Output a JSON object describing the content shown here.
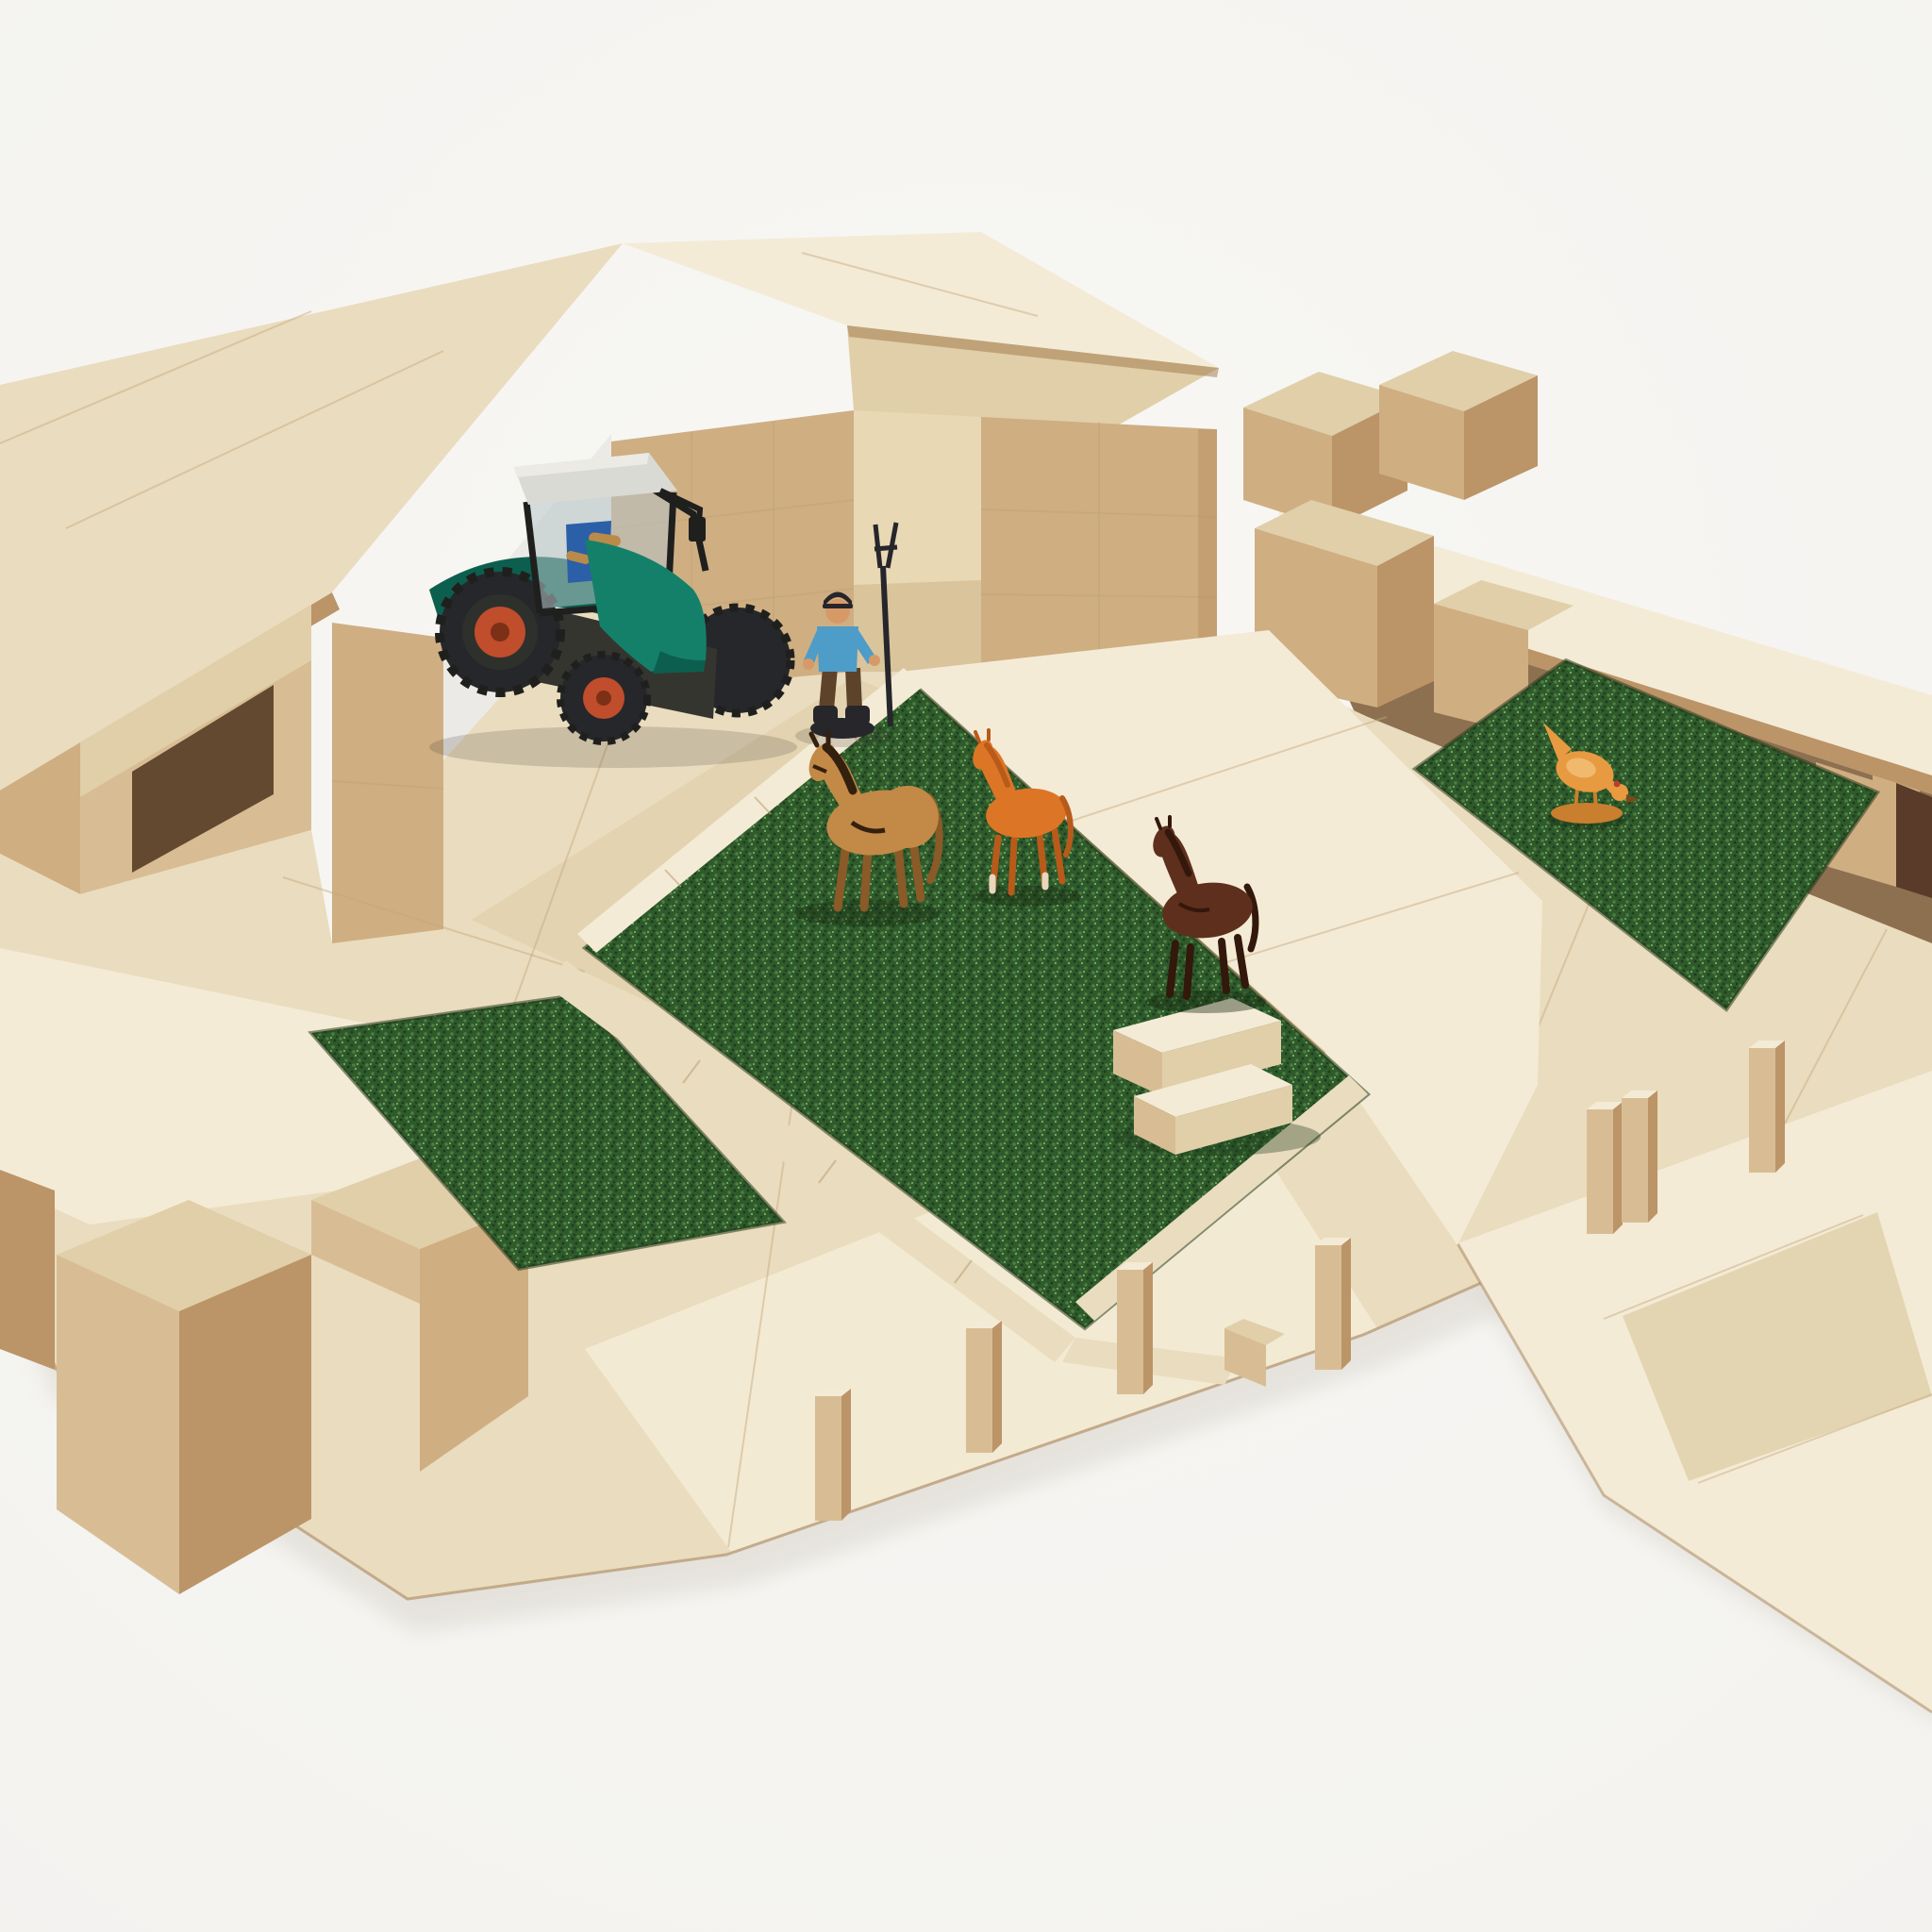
{
  "scene": {
    "type": "product photograph",
    "description": "Toy farm built from natural wooden building blocks and plywood panels on a white studio background: a barn with sloped plywood roofs shelters a green toy tractor, a farmer figure with a pitchfork stands by the entrance, a turf paddock fenced with flat wooden rails holds a tan horse, an orange foal and a dark brown horse beside a block feeding trough, a low shed with a flat plywood roof covers a second turf patch with a pecking hen, a small turf strip sits on the left platform, and upright fence-post blocks line the foreground beside a plywood driveway."
  },
  "objects": {
    "barn": {
      "label": "block barn with plywood gable roof"
    },
    "left_stable": {
      "label": "open stable wing with dark doorway"
    },
    "tractor_bay": {
      "label": "open tractor bay"
    },
    "right_shed": {
      "label": "low shed with flat plywood roof and blocks on top"
    },
    "tractor": {
      "label": "green toy tractor with white cab, black roll cage and red wheel hubs"
    },
    "farmer": {
      "label": "farmer figure in blue shirt holding a black pitchfork"
    },
    "paddock": {
      "label": "artificial turf paddock edged with flat wooden rails"
    },
    "walkway": {
      "label": "raised plywood walkway between paddock and shed turf"
    },
    "trough": {
      "label": "feeding trough stacked from small wooden blocks"
    },
    "horse_mare": {
      "label": "tan horse with dark mane and harness"
    },
    "horse_foal": {
      "label": "orange foal with pale lower legs"
    },
    "horse_brown": {
      "label": "dark brown horse"
    },
    "chicken": {
      "label": "orange hen pecking the turf"
    },
    "left_grass": {
      "label": "small turf strip inlaid in the left platform"
    },
    "right_grass": {
      "label": "turf patch in front of the shed"
    },
    "driveway": {
      "label": "plywood driveway leading off to the lower right"
    },
    "fence_posts": {
      "label": "upright fence-post blocks",
      "count": 7
    },
    "corner_blocks": {
      "label": "large square blocks at the lower-left corner"
    }
  },
  "colors": {
    "bg": "#f3f2ef",
    "bg_hi": "#f8f7f4",
    "backdrop_gap": "#eceae6",
    "wood_bright": "#f4ebd6",
    "wood_pale": "#eadcbe",
    "wood_pale2": "#e0cfa9",
    "wood_mid": "#d8bd94",
    "wood_tan": "#cfae82",
    "wood_dark": "#bb9468",
    "wood_deep": "#9e7648",
    "wood_edge": "#c3a67c",
    "interior_light": "#e8d8b4",
    "interior_mid": "#d9c49c",
    "interior_shadow": "#8d7050",
    "interior_dark": "#63492f",
    "grass_base": "#2e5a2c",
    "grass_light": "#4c8040",
    "grass_dark": "#1e3b1c",
    "grass_hi": "#7aa862",
    "grass_edge": "#243c1b",
    "tractor_green": "#15806a",
    "tractor_green_dark": "#0c5f4e",
    "cab_white": "#d9dad4",
    "cab_glass": "#b7c5c9",
    "roll_black": "#1f201e",
    "tire": "#26272a",
    "hub_red": "#c04d2b",
    "hub_dark": "#7c3015",
    "seat_blue": "#2b5fa8",
    "chassis": "#35352f",
    "shirt_blue": "#4e9cc8",
    "pants_brown": "#5e432b",
    "skin": "#d79a67",
    "gear_dark": "#26262b",
    "horse_tan": "#c28947",
    "horse_tan_dark": "#8a5a28",
    "horse_mane": "#33200e",
    "foal_orange": "#dd7526",
    "foal_shade": "#b85a1a",
    "foal_sock": "#e9d6bd",
    "horse_brown": "#5e2f1c",
    "horse_brown_dark": "#33180c",
    "chicken_orange": "#e89a40",
    "chicken_shade": "#c97f2e",
    "chicken_hi": "#f3c37c",
    "comb_red": "#c03b2a",
    "beak": "#7a4a1a"
  }
}
